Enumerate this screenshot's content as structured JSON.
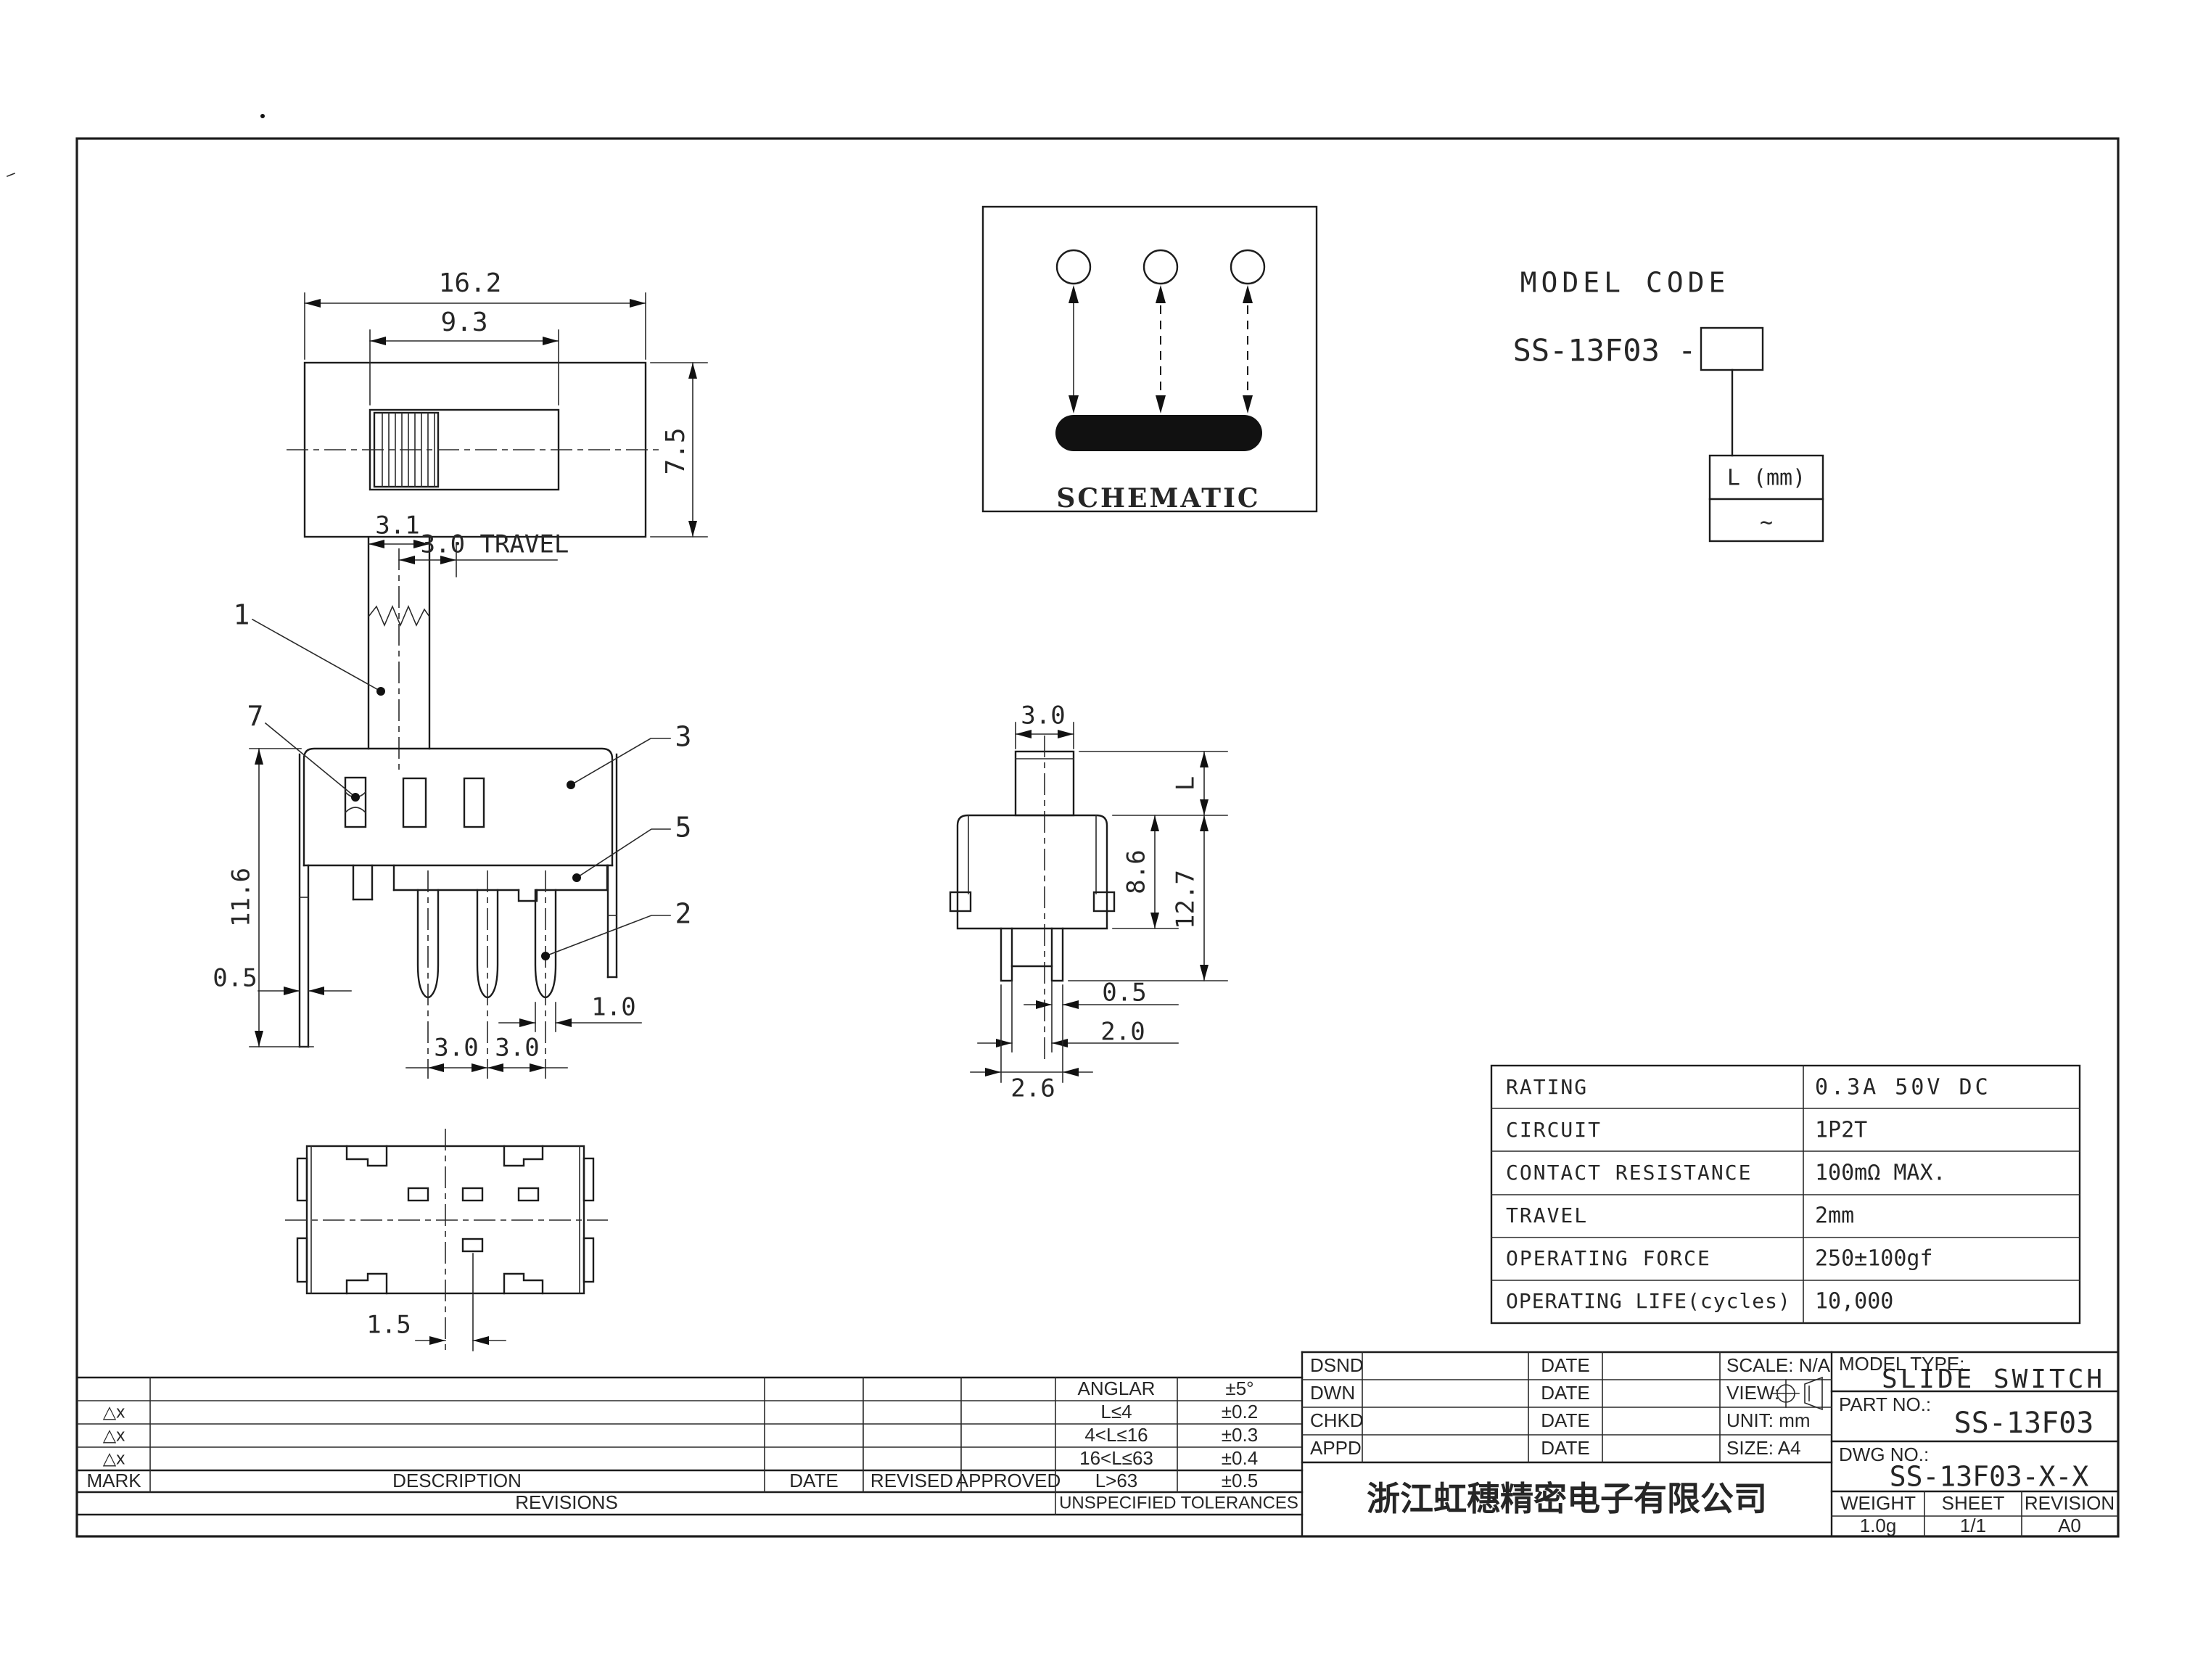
{
  "drawing": {
    "top_view": {
      "dim_width": "16.2",
      "dim_slot": "9.3",
      "dim_height": "7.5"
    },
    "schematic": {
      "title": "SCHEMATIC"
    },
    "model_code": {
      "heading": "MODEL CODE",
      "code_prefix": "SS-13F03 -",
      "length_header": "L (mm)",
      "length_value": "~"
    },
    "front_view": {
      "dim_knob_width": "3.1",
      "dim_travel": "3.0 TRAVEL",
      "dim_height": "11.6",
      "dim_plate": "0.5",
      "dim_pitch_a": "3.0",
      "dim_pitch_b": "3.0",
      "dim_pin_width": "1.0",
      "callout_1": "1",
      "callout_7": "7",
      "callout_3": "3",
      "callout_5": "5",
      "callout_2": "2"
    },
    "side_view": {
      "dim_knob": "3.0",
      "dim_l": "L",
      "dim_body": "8.6",
      "dim_total": "12.7",
      "dim_pin_t": "0.5",
      "dim_pin_gap": "2.0",
      "dim_span": "2.6"
    },
    "bottom_view": {
      "dim_offset": "1.5"
    }
  },
  "spec_table": {
    "rows": [
      {
        "label": "RATING",
        "value": "0.3A 50V DC"
      },
      {
        "label": "CIRCUIT",
        "value": "1P2T"
      },
      {
        "label": "CONTACT RESISTANCE",
        "value": "100mΩ MAX."
      },
      {
        "label": "TRAVEL",
        "value": "2mm"
      },
      {
        "label": "OPERATING FORCE",
        "value": "250±100gf"
      },
      {
        "label": "OPERATING LIFE(cycles)",
        "value": "10,000"
      }
    ]
  },
  "tolerance_table": {
    "col_headers": {
      "mark": "MARK",
      "description": "DESCRIPTION",
      "date": "DATE",
      "revised": "REVISED",
      "approved": "APPROVED"
    },
    "rows": [
      {
        "mark": "",
        "range": "ANGLAR",
        "tol": "±5°"
      },
      {
        "mark": "△x",
        "range": "L≤4",
        "tol": "±0.2"
      },
      {
        "mark": "△x",
        "range": "4<L≤16",
        "tol": "±0.3"
      },
      {
        "mark": "△x",
        "range": "16<L≤63",
        "tol": "±0.4"
      },
      {
        "mark": "",
        "range": "L>63",
        "tol": "±0.5"
      }
    ],
    "revisions_label": "REVISIONS",
    "unspecified_label": "UNSPECIFIED TOLERANCES"
  },
  "title_block": {
    "sign_rows": [
      {
        "role": "DSND",
        "date": "DATE"
      },
      {
        "role": "DWN",
        "date": "DATE"
      },
      {
        "role": "CHKD",
        "date": "DATE"
      },
      {
        "role": "APPD",
        "date": "DATE"
      }
    ],
    "scale": "SCALE: N/A",
    "view": "VIEW:",
    "unit": "UNIT: mm",
    "size": "SIZE: A4",
    "model_type_label": "MODEL TYPE:",
    "model_type": "SLIDE SWITCH",
    "part_no_label": "PART NO.:",
    "part_no": "SS-13F03",
    "dwg_no_label": "DWG NO.:",
    "dwg_no": "SS-13F03-X-X",
    "weight_label": "WEIGHT",
    "sheet_label": "SHEET",
    "revision_label": "REVISION",
    "weight": "1.0g",
    "sheet": "1/1",
    "revision": "A0",
    "company": "浙江虹穗精密电子有限公司"
  }
}
